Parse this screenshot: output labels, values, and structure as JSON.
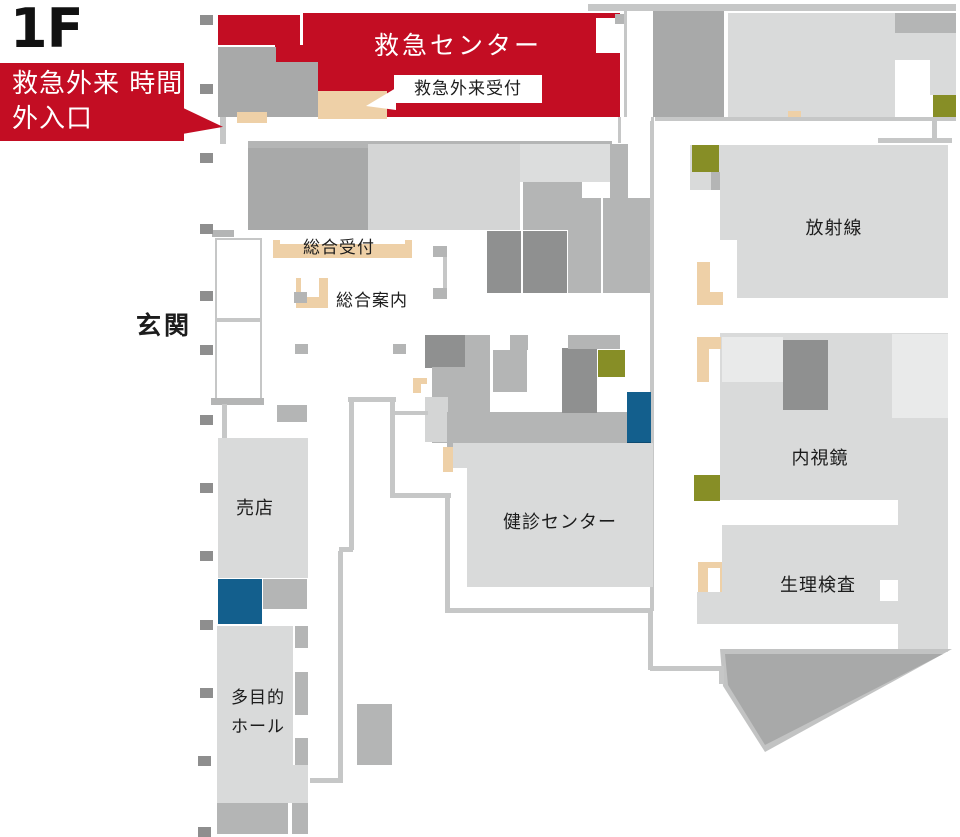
{
  "colors": {
    "red": "#c30d23",
    "beige": "#eed0a7",
    "olive": "#878e26",
    "blue": "#135f8d",
    "blue_dark": "#0e4a70"
  },
  "floor": {
    "label": "1F"
  },
  "callout": {
    "text": "救急外来\n時間外入口"
  },
  "rooms": {
    "emergency_center": "救急センター",
    "radiology": "放射線",
    "endoscopy": "内視鏡",
    "physiology_lab": "生理検査",
    "checkup_center": "健診センター",
    "shop": "売店",
    "multipurpose_hall": "多目的\nホール"
  },
  "labels": {
    "emergency_reception": "救急外来受付",
    "general_reception": "総合受付",
    "general_information": "総合案内",
    "entrance": "玄関"
  }
}
